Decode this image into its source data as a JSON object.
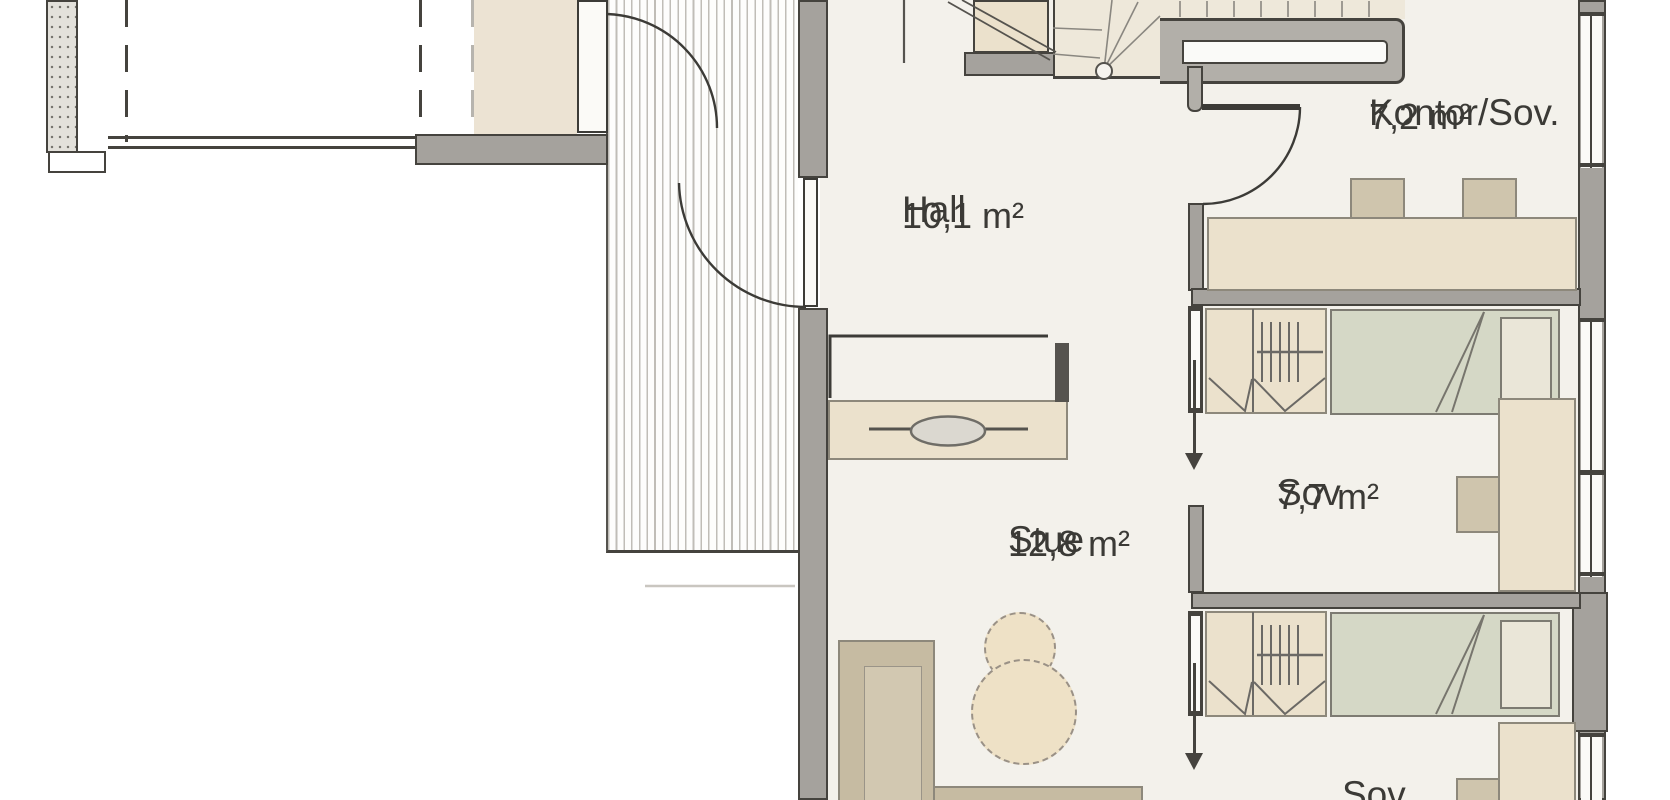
{
  "rooms": {
    "hall": {
      "name": "Hall",
      "area": "10,1 m²"
    },
    "kontor": {
      "name": "Kontor/Sov.",
      "area": "7,2 m²"
    },
    "sov1": {
      "name": "Sov",
      "area": "7,7 m²"
    },
    "stue": {
      "name": "Stue",
      "area": "12,8 m²"
    },
    "sov2": {
      "name": "Sov"
    }
  },
  "colors": {
    "wall": "#a5a29d",
    "wall_outline": "#45433e",
    "floor": "#f3f1eb",
    "furniture_beige": "#ebe1cc",
    "furniture_chair": "#cfc5ad",
    "bed_blanket": "#d5d8c6",
    "bed_pillow": "#eae6d8",
    "sofa": "#c6bba2",
    "deck_stripe": "#c0bdb7",
    "text": "#3b3a36"
  }
}
